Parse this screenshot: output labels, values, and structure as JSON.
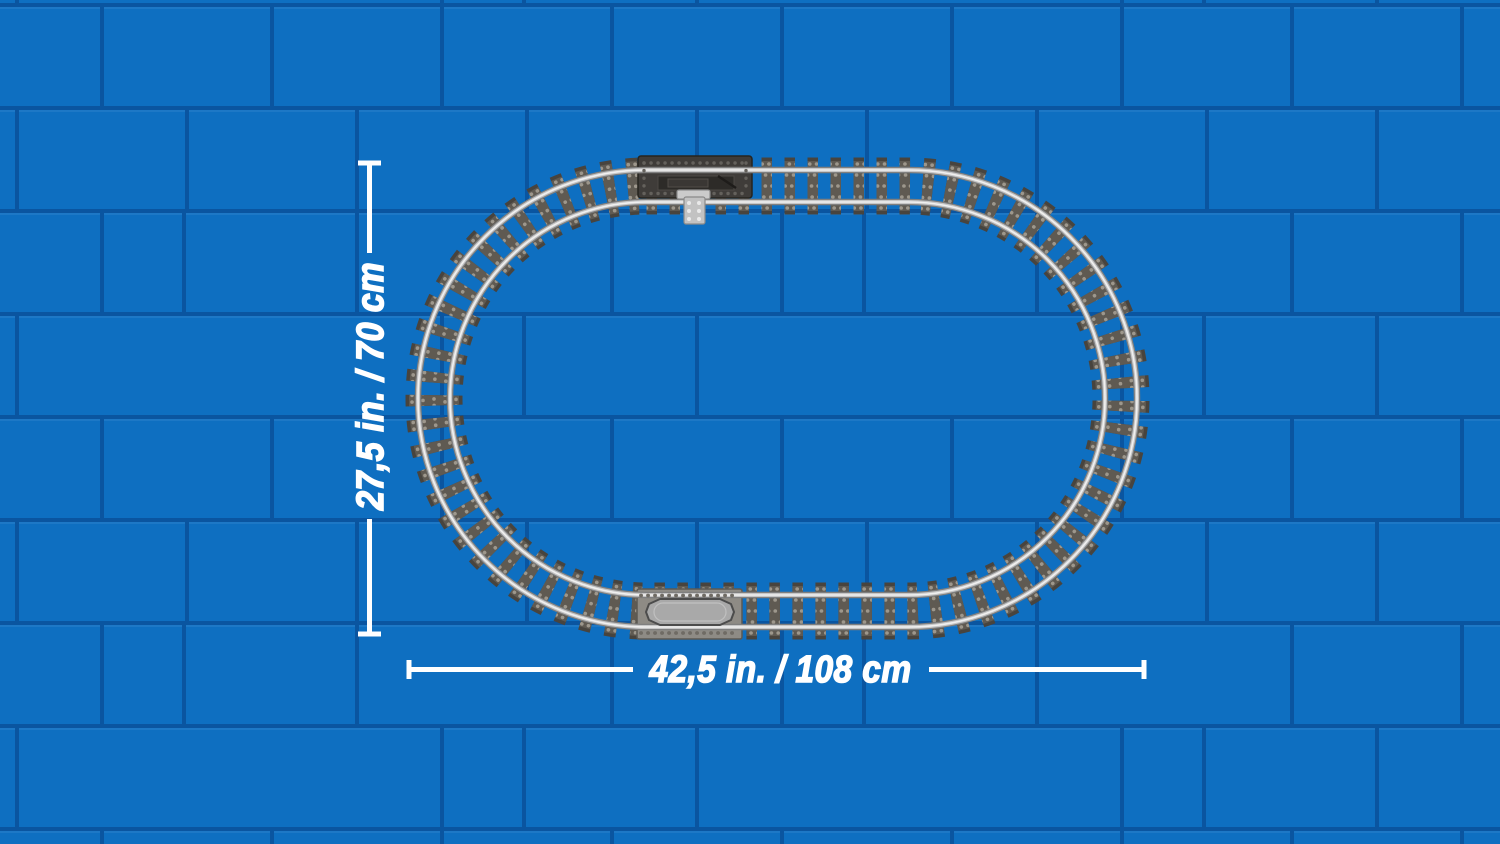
{
  "dimensions": {
    "height_label": "27,5 in. / 70 cm",
    "width_label": "42,5 in. / 108 cm"
  },
  "colors": {
    "wall_brick": "#0e6fc1",
    "wall_mortar": "#0a55a0",
    "wall_mortar_highlight": "#2e83cd",
    "tie_base": "#48443e",
    "tie_top": "#5f5a52",
    "stud": "#9d978c",
    "rail": "#c6c6c6",
    "rail_shadow": "#7f7f7f",
    "rail_highlight": "#f0f0f0",
    "switch_plate": "#3f3c39",
    "switch_lever": "#c2c2c2",
    "decoupler_plate": "#8e8b85",
    "decoupler_slide": "#a9a9a9",
    "dimension_line": "#ffffff"
  }
}
